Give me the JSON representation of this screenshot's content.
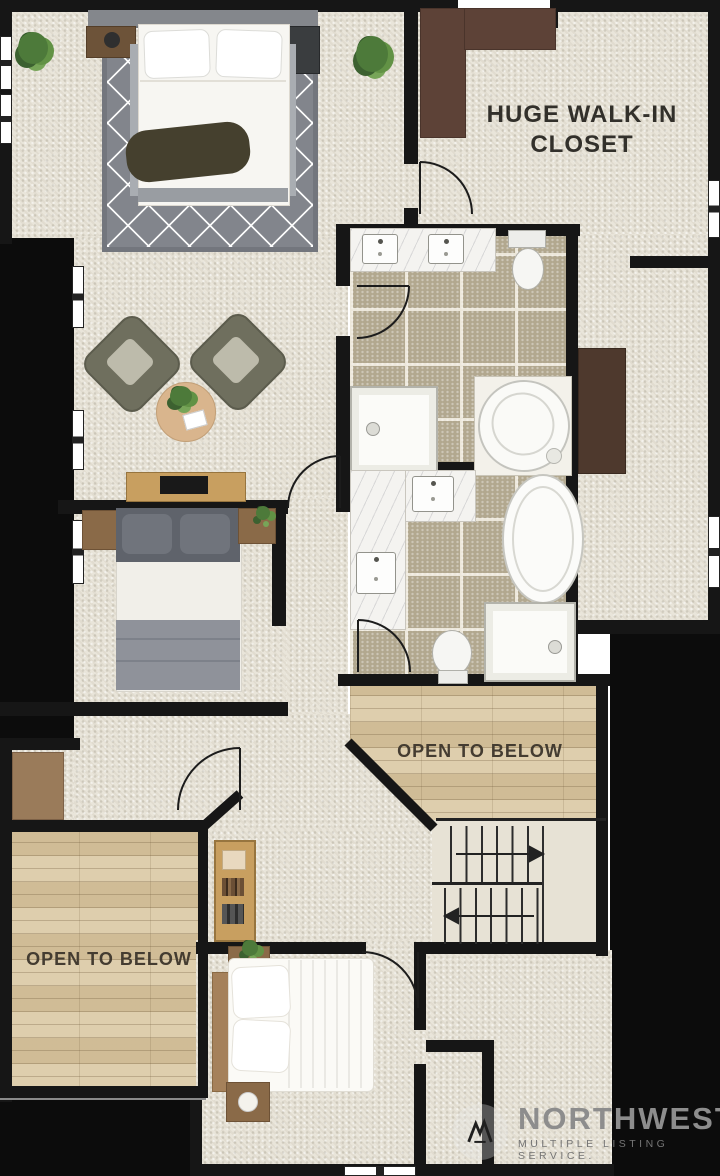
{
  "labels": {
    "walk_in_closet": "HUGE WALK-IN CLOSET",
    "open_to_below_mid": "OPEN TO BELOW",
    "open_to_below_bottom": "OPEN TO BELOW"
  },
  "watermark": {
    "brand": "NORTHWEST",
    "tagline": "MULTIPLE LISTING SERVICE."
  },
  "palette": {
    "wall": "#161616",
    "carpet": "#e9e5da",
    "tile": "#b2a88f",
    "grout": "#ece7da",
    "wood_floor": "#d8c6a0",
    "marble": "#f4f3f0",
    "rug": "#82858c",
    "dark_wardrobe": "#5d4237",
    "wood_furniture": "#c89f60",
    "label_text": "#39332a",
    "watermark_text": "#8d8d8d"
  }
}
